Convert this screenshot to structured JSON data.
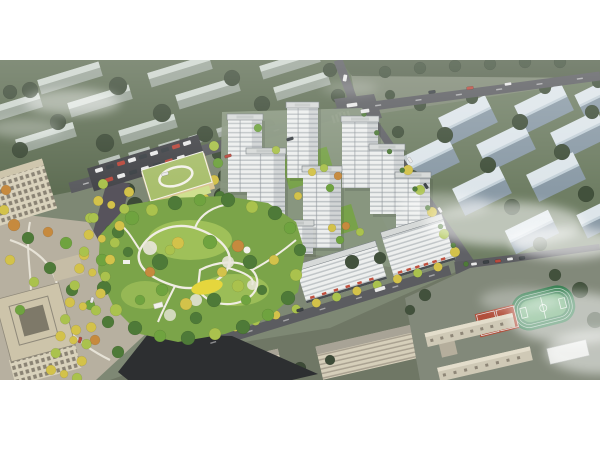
{
  "meta": {
    "type": "architectural-aerial-rendering",
    "alt": "Aerial rendering of a residential masterplan: white high-rise towers around a lush central park with winding white paths and a yellow playground, a green-roofed kindergarten with parking lot, a tree-lined boulevard, beige office buildings at lower left, a school campus with green sports field and red courts at lower right, all surrounded by muted gray-green context blocks, roads with small vehicles and drifting white mist."
  },
  "regions": {
    "context_left": "surrounding low-rise blocks (north-west)",
    "context_right": "surrounding residential slabs (east)",
    "context_south": "surrounding blocks (south)",
    "roads": "road network with lane markings",
    "boulevard": "tree-lined boulevard",
    "residential_site": "new residential towers",
    "central_park": "central landscaped park",
    "kindergarten": "kindergarten with green roof",
    "parking": "surface parking lot",
    "offices": "office buildings and plaza",
    "school": "school campus",
    "sports_field": "running track and courts",
    "vehicles": "cars and buses",
    "mist": "drifting clouds"
  },
  "palette": {
    "base_ground": "#7e8874",
    "ctx_left_grass": "#5f6e54",
    "ctx_left_tree": "#3d4b37",
    "ctx_left_slab": "#97a296",
    "ctx_left_slab_top": "#ccd5cd",
    "ctx_right_grass": "#6f7e64",
    "ctx_right_tree": "#42513c",
    "ctx_right_slab": "#8a9aa6",
    "ctx_right_slab_top": "#dde5ea",
    "ctx_right_slab_edge": "#c3d0d8",
    "road": "#5b5c60",
    "road_dark": "#2d2f31",
    "boulevard_asphalt": "#57535c",
    "tower_face": "#edefee",
    "tower_stripe": "#9aa1a7",
    "tower_side": "#b9c0c4",
    "tower_roof": "#d6d9d8",
    "podium_green": "#78a24a",
    "park_green": "#7ba449",
    "lawn": "#a9c75e",
    "tree_green": "#4e7a38",
    "tree_bright": "#6fa33f",
    "tree_lime": "#aac24d",
    "tree_yellow": "#d3c24a",
    "tree_orange": "#c68a3e",
    "path_white": "#f0ede3",
    "playground": "#e5d63d",
    "water_blue": "#5aa3c0",
    "beige_face": "#d6cfba",
    "beige_win": "#7d7668",
    "beige_roof": "#a8a396",
    "office_roof": "#cdc4aa",
    "office_face": "#d9d2bc",
    "plaza": "#b7b0a0",
    "kinder_roof": "#a9bf6d",
    "kinder_face": "#ecd9a2",
    "field_track": "#2f7a4b",
    "field_pitch": "#5aa369",
    "court_red": "#b14f3b",
    "campus_ground": "#82897a",
    "south_ground": "#6f7765",
    "awning_red": "#c0503e",
    "car_white": "#e9e9e9",
    "car_red": "#b94a3e",
    "car_dark": "#3c4246",
    "mist_white": "#ffffff"
  }
}
